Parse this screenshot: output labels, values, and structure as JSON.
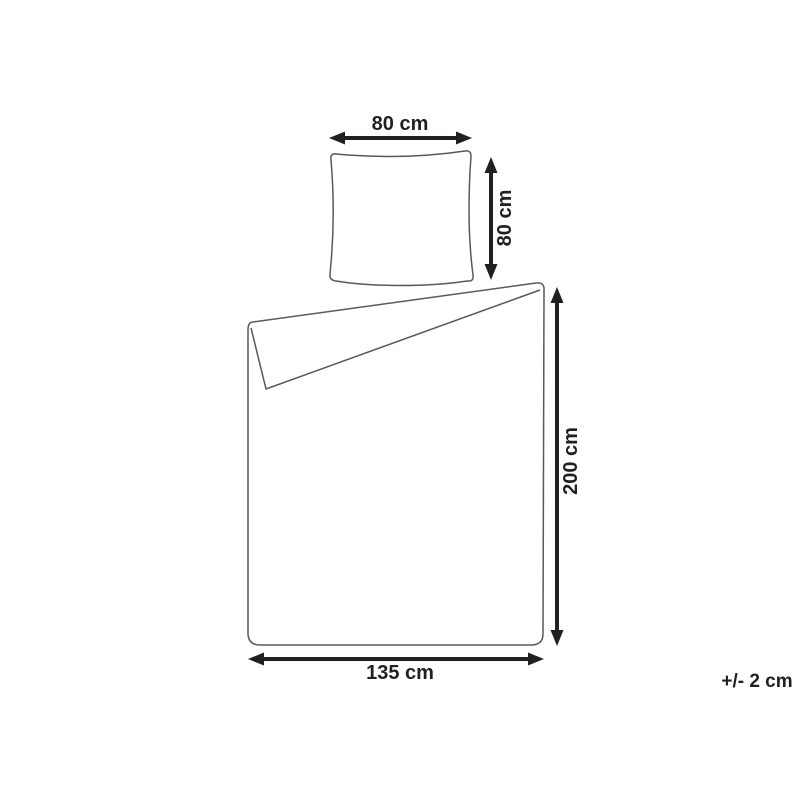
{
  "colors": {
    "background": "#ffffff",
    "outline": "#58595b",
    "arrow": "#231f20",
    "label": "#231f20"
  },
  "labels": {
    "pillow_width": "80 cm",
    "pillow_height": "80 cm",
    "duvet_height": "200 cm",
    "duvet_width": "135 cm",
    "tolerance": "+/- 2 cm"
  }
}
